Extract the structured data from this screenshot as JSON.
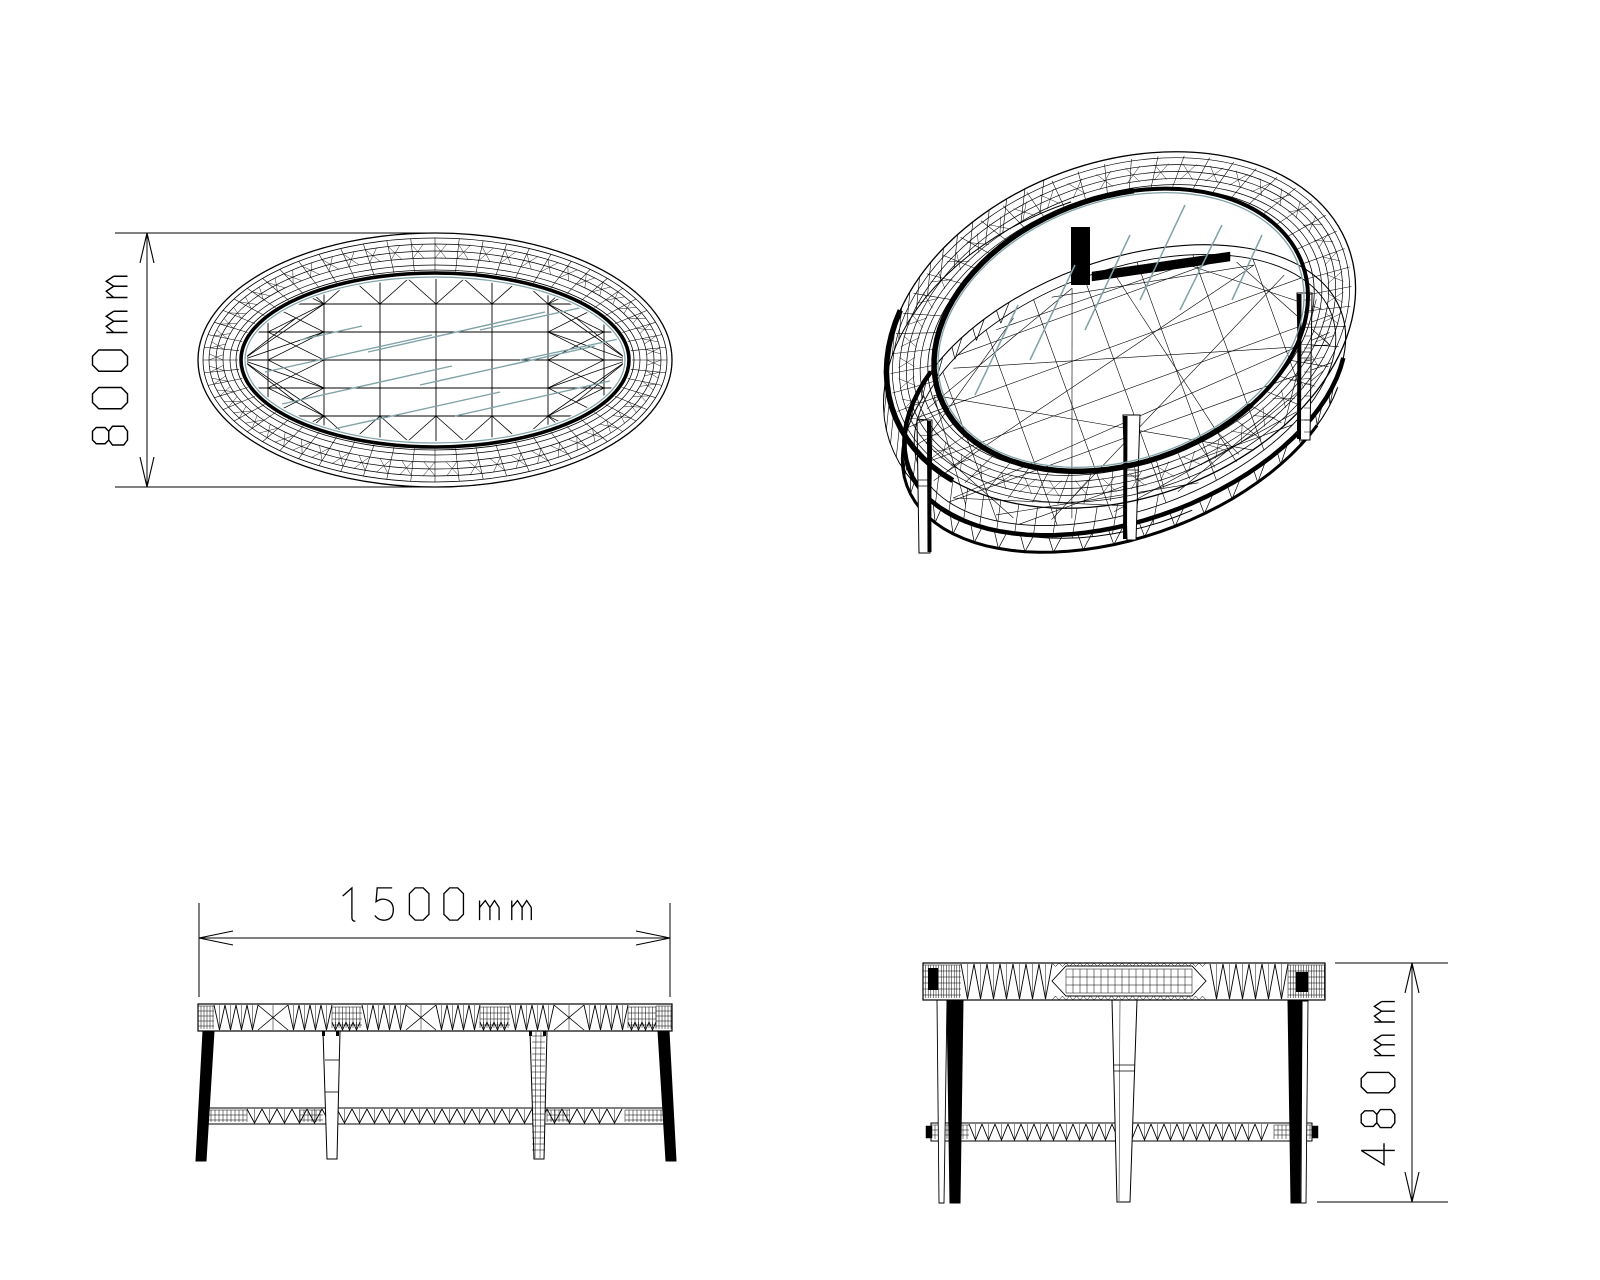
{
  "page": {
    "background": "#ffffff"
  },
  "style": {
    "ink": "#000000",
    "glass_tint": "#7fa2a6",
    "leg_fill": "#ffffff"
  },
  "views": {
    "top": {
      "dimension": {
        "label": "800mm",
        "value": 800,
        "unit": "mm",
        "axis": "vertical"
      }
    },
    "isometric": {},
    "front": {
      "dimension": {
        "label": "1500mm",
        "value": 1500,
        "unit": "mm",
        "axis": "horizontal"
      }
    },
    "side": {
      "dimension": {
        "label": "480mm",
        "value": 480,
        "unit": "mm",
        "axis": "vertical"
      }
    }
  }
}
